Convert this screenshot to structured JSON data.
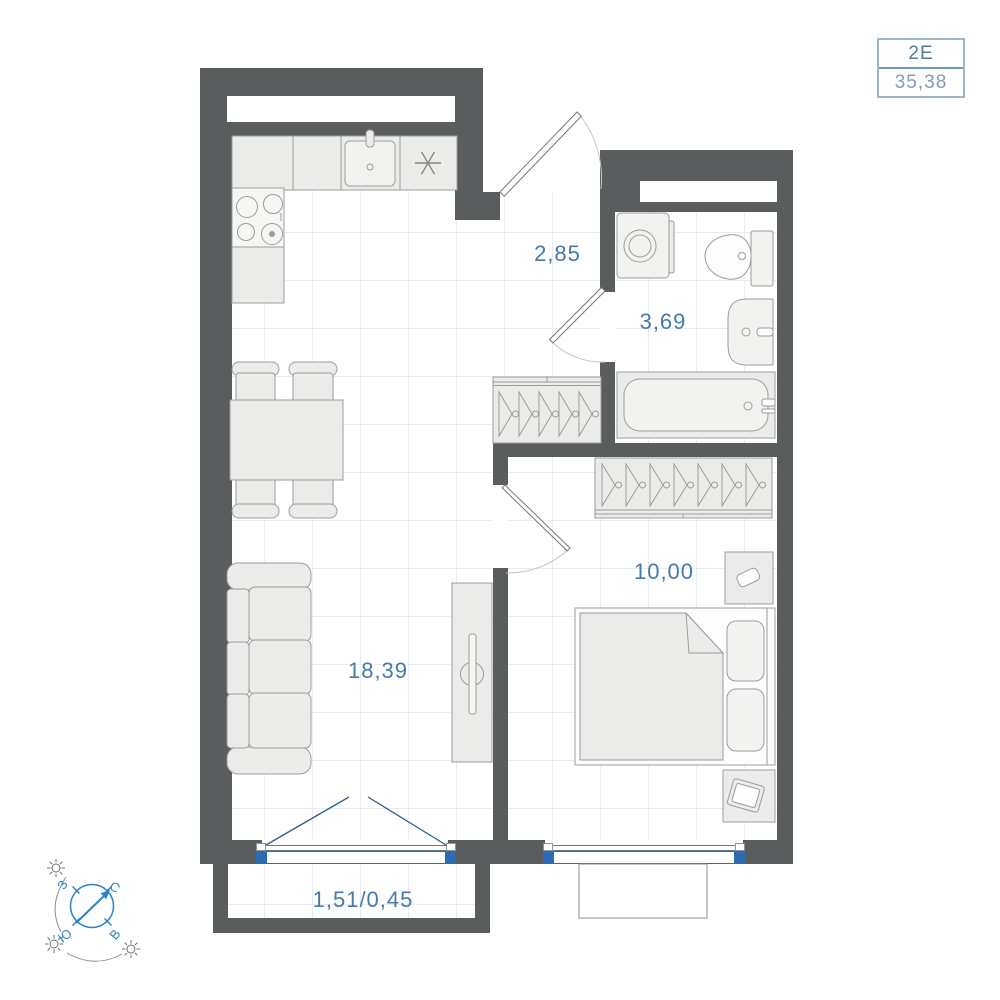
{
  "plan_badge": {
    "layout_code": "2Е",
    "total_area": "35,38"
  },
  "room_labels": {
    "hallway": "2,85",
    "bathroom": "3,69",
    "bedroom": "10,00",
    "living_kitchen": "18,39",
    "balcony": "1,51/0,45"
  },
  "compass": {
    "north": "С",
    "east": "В",
    "south": "Ю",
    "west": "З"
  },
  "colors": {
    "wall": "#595d5d",
    "furniture_fill": "#ebebe9",
    "furniture_outline": "#9c9c9a",
    "window_blue": "#2d6ca6",
    "label_blue": "#4779a9",
    "compass_blue": "#2d83c5",
    "badge_border": "#9fb6c9",
    "grid_line": "#e9edf1"
  },
  "icons": {
    "fridge_symbol": "✳",
    "sun_symbol": "☼",
    "north_arrow": "↗"
  }
}
